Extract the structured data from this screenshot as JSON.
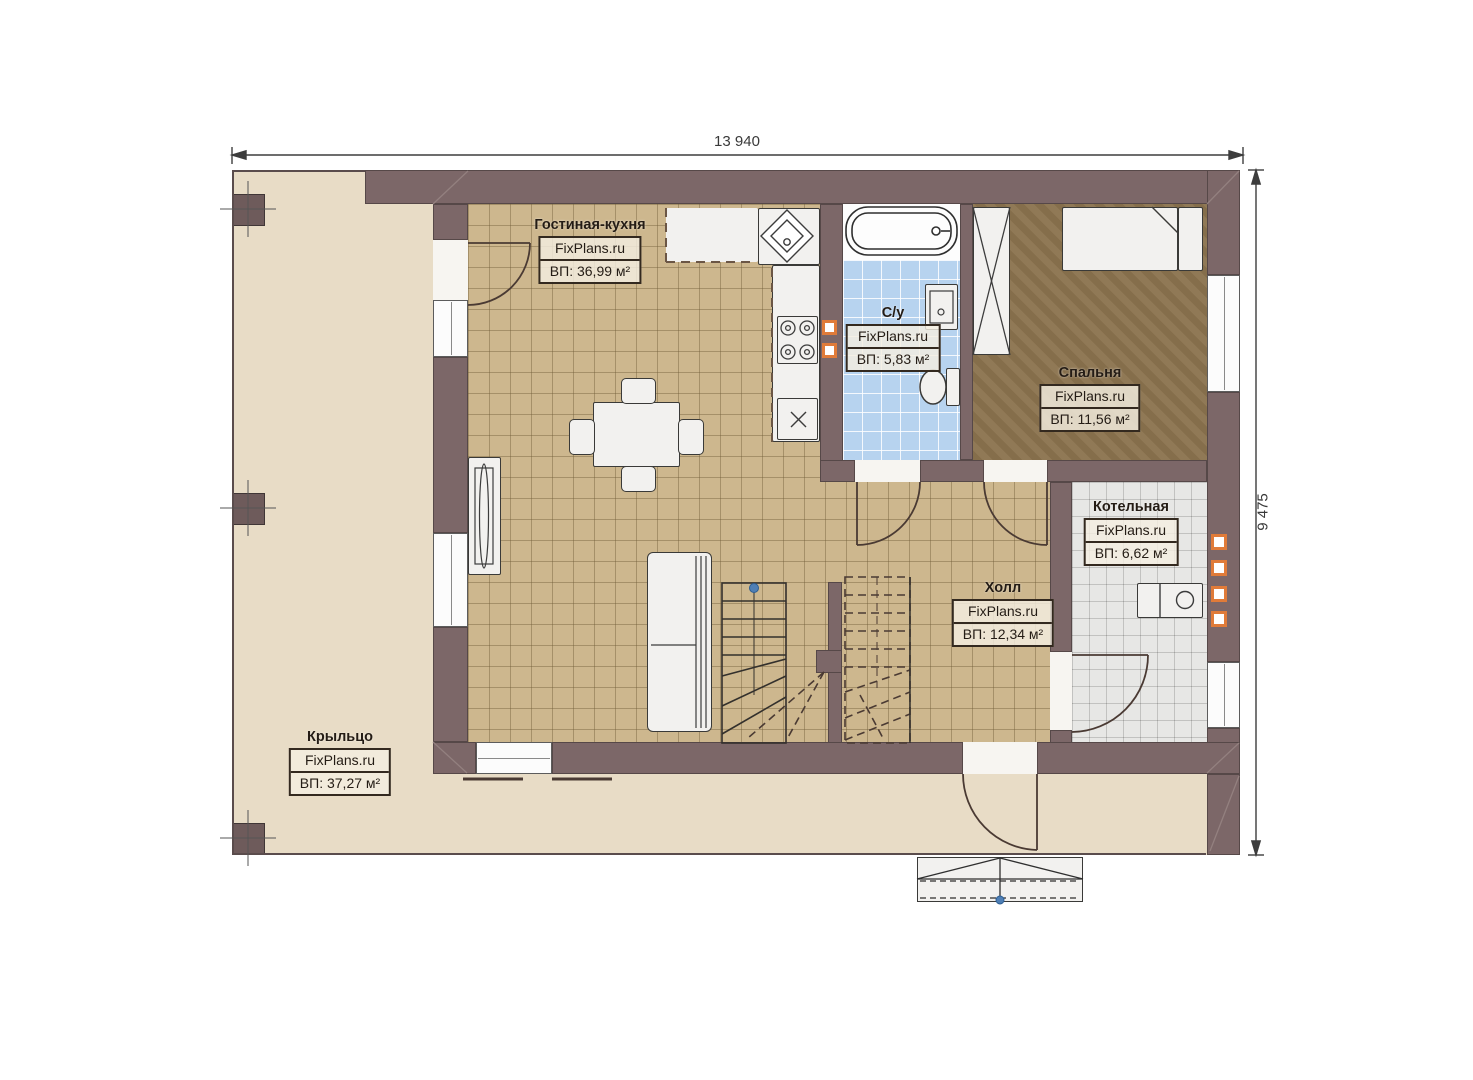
{
  "plan": {
    "dimension_top": "13 940",
    "dimension_right": "9 475",
    "watermark": "FixPlans.ru",
    "rooms": {
      "living": {
        "name": "Гостиная-кухня",
        "brand": "FixPlans.ru",
        "area": "ВП: 36,99 м²"
      },
      "bathroom": {
        "name": "С/у",
        "brand": "FixPlans.ru",
        "area": "ВП: 5,83 м²"
      },
      "bedroom": {
        "name": "Спальня",
        "brand": "FixPlans.ru",
        "area": "ВП: 11,56 м²"
      },
      "boiler": {
        "name": "Котельная",
        "brand": "FixPlans.ru",
        "area": "ВП: 6,62 м²"
      },
      "hall": {
        "name": "Холл",
        "brand": "FixPlans.ru",
        "area": "ВП: 12,34 м²"
      },
      "porch": {
        "name": "Крыльцо",
        "brand": "FixPlans.ru",
        "area": "ВП: 37,27 м²"
      }
    },
    "colors": {
      "wall": "#7c6768",
      "floor_tile": "#cdb78e",
      "bedroom_floor": "#8c744f",
      "bathroom_tile": "#b7d3ef",
      "boiler_tile": "#e7e7e5",
      "porch": "#e8dcc6",
      "accent_orange": "#e07b39"
    }
  }
}
